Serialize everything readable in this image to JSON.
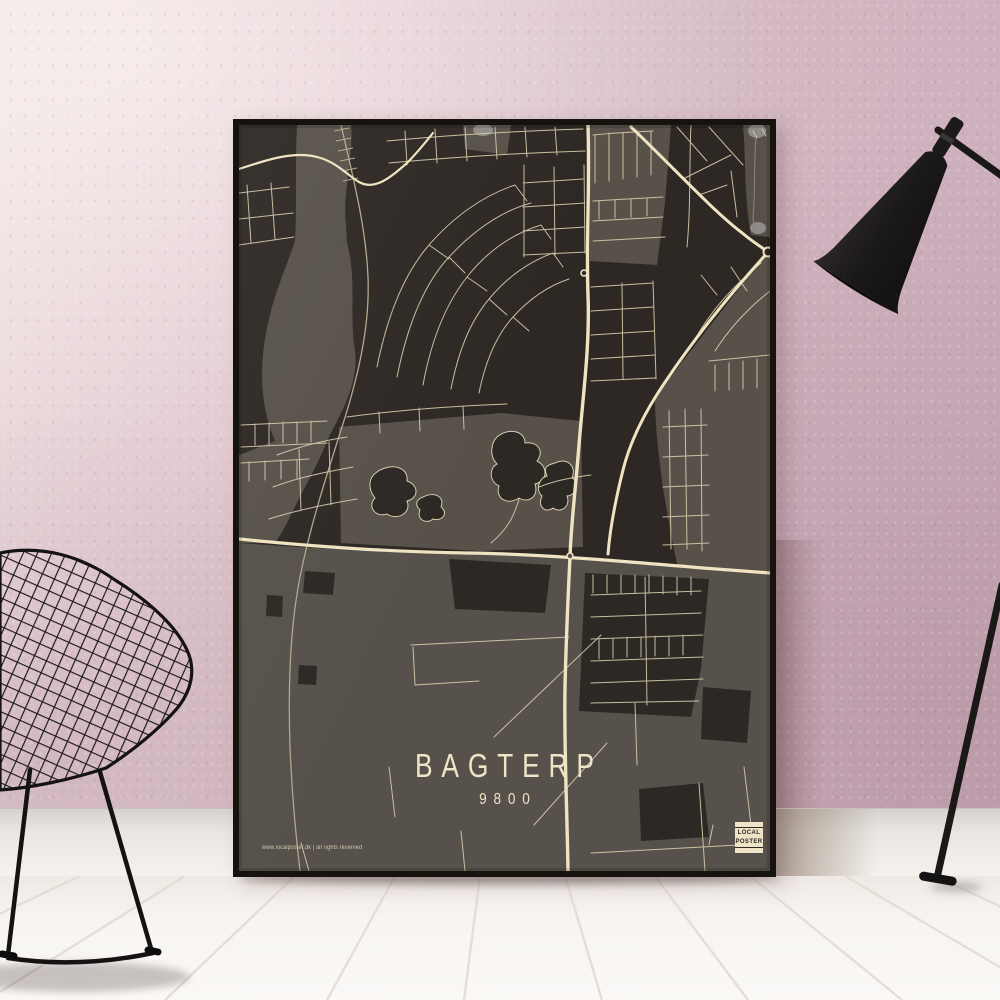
{
  "scene": {
    "description": "Framed dark city-map poster leaning against a pink plaster wall on a white plank floor, black wire diamond chair at left, black floor lamp at right",
    "wall_color": "#d7bdc6",
    "baseboard_color": "#e9e6e3",
    "floor_color": "#f7f4f1",
    "chair": "black wire diamond chair",
    "lamp": "black floor lamp"
  },
  "poster": {
    "title": "BAGTERP",
    "postal_code": "9800",
    "footer_text": "www.localposter.dk | all rights reserved",
    "logo": {
      "line1": "LOCAL",
      "line2": "POSTER"
    },
    "colors": {
      "frame": "#16120e",
      "map_background": "#2d2823",
      "map_secondary_gray": "#57514a",
      "roads": "#e9dcba",
      "main_roads": "#f0e3c1",
      "text": "#efe4c8"
    }
  }
}
